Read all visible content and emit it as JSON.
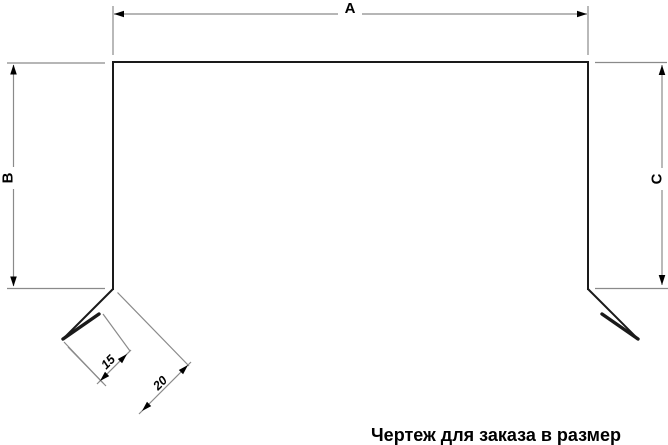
{
  "labels": {
    "dim_a": "A",
    "dim_b": "B",
    "dim_c": "C",
    "dim_15": "15",
    "dim_20": "20"
  },
  "caption": "Чертеж для заказа в размер",
  "colors": {
    "background": "#ffffff",
    "profile": "#1a1a1a",
    "dimension": "#8a8a8a",
    "text": "#000000"
  }
}
